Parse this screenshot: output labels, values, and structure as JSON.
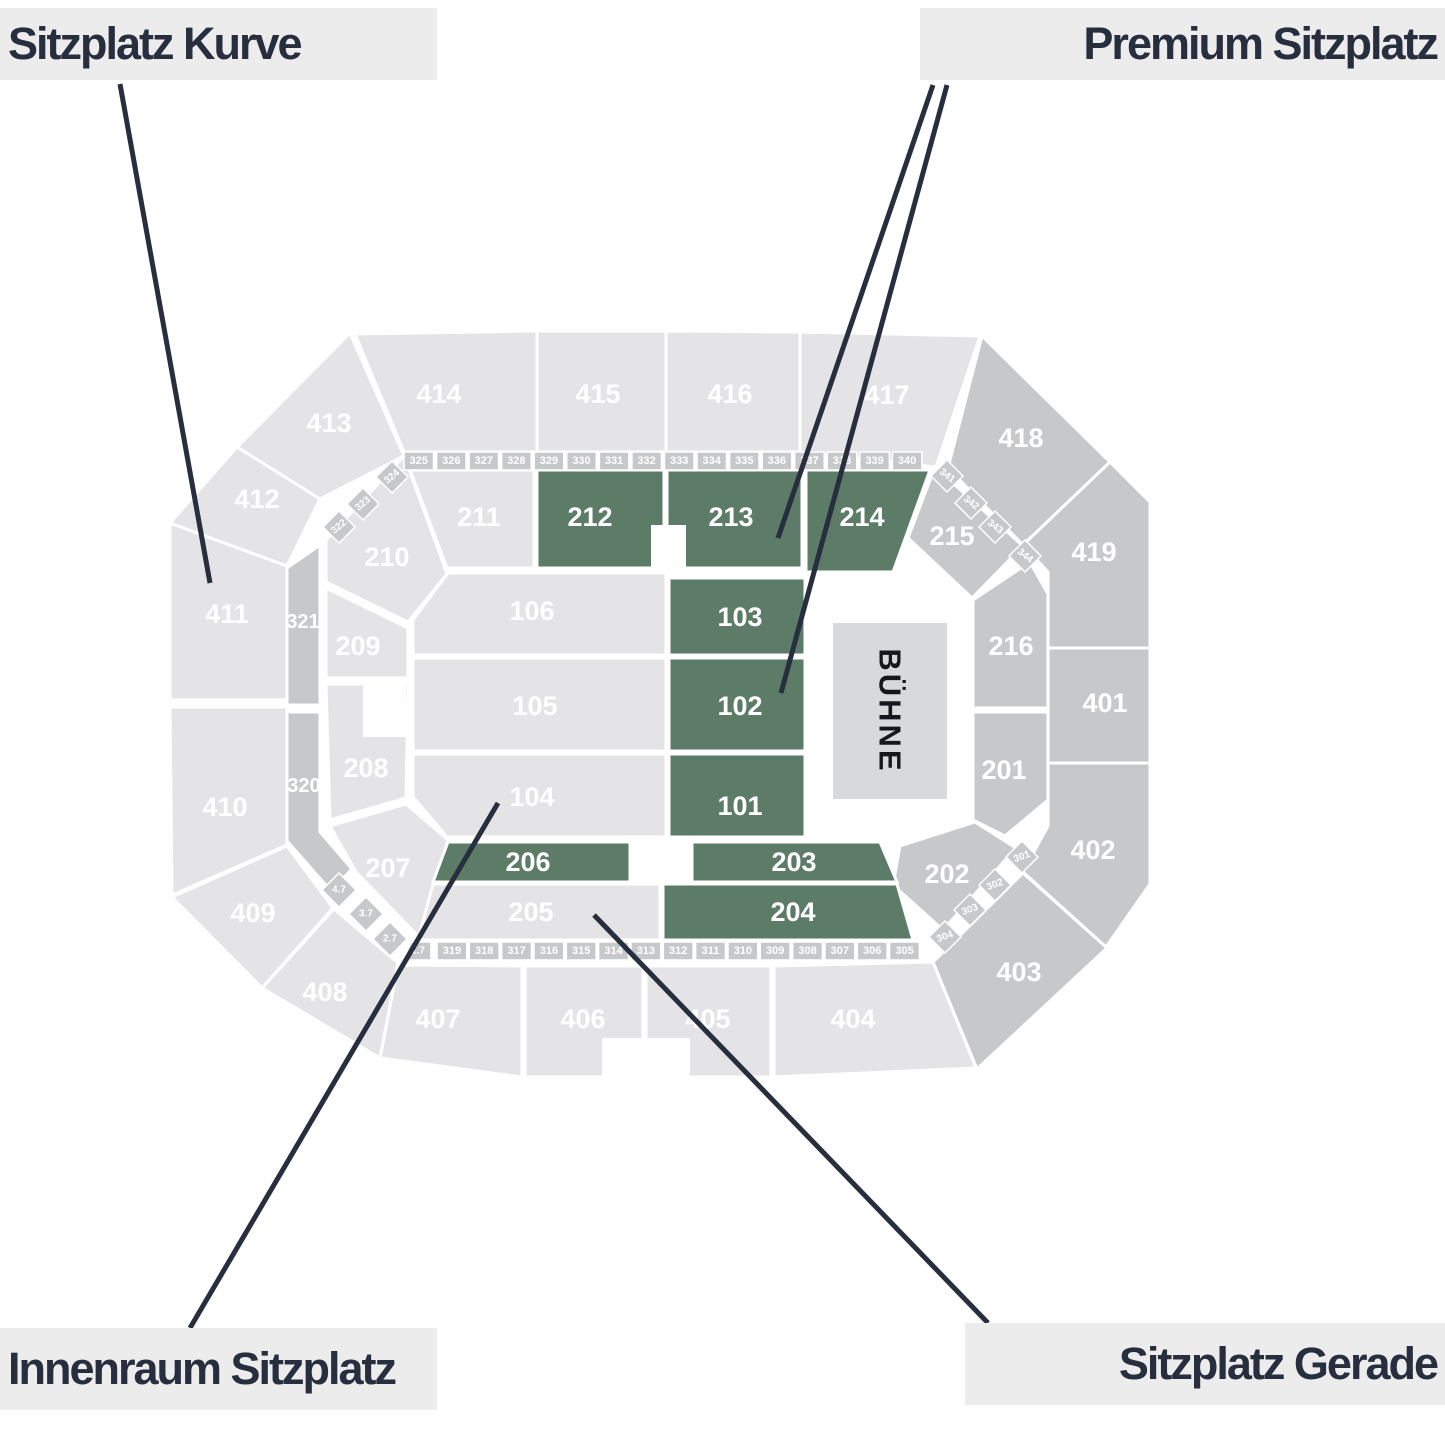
{
  "palette": {
    "light": "#e4e4e6",
    "mid": "#c7c8ca",
    "green": "#5d7c68",
    "stage_bg": "#d8d9db",
    "label_bg": "#ececec",
    "ink": "#272e3e",
    "section_text": "#ffffff",
    "stage_text": "#15171c"
  },
  "legend": {
    "top_left": "Sitzplatz Kurve",
    "top_right": "Premium Sitzplatz",
    "bottom_left": "Innenraum Sitzplatz",
    "bottom_right": "Sitzplatz Gerade"
  },
  "stage": {
    "label": "BÜHNE"
  },
  "sections": [
    {
      "id": "413",
      "label": "413",
      "role": "light"
    },
    {
      "id": "414",
      "label": "414",
      "role": "light"
    },
    {
      "id": "415",
      "label": "415",
      "role": "light"
    },
    {
      "id": "416",
      "label": "416",
      "role": "light"
    },
    {
      "id": "417",
      "label": "417",
      "role": "light"
    },
    {
      "id": "418",
      "label": "418",
      "role": "mid"
    },
    {
      "id": "419",
      "label": "419",
      "role": "mid"
    },
    {
      "id": "401",
      "label": "401",
      "role": "mid"
    },
    {
      "id": "402",
      "label": "402",
      "role": "mid"
    },
    {
      "id": "403",
      "label": "403",
      "role": "mid"
    },
    {
      "id": "404",
      "label": "404",
      "role": "light"
    },
    {
      "id": "405",
      "label": "405",
      "role": "light"
    },
    {
      "id": "406",
      "label": "406",
      "role": "light"
    },
    {
      "id": "407",
      "label": "407",
      "role": "light"
    },
    {
      "id": "408",
      "label": "408",
      "role": "light"
    },
    {
      "id": "409",
      "label": "409",
      "role": "light"
    },
    {
      "id": "410",
      "label": "410",
      "role": "light"
    },
    {
      "id": "411",
      "label": "411",
      "role": "light"
    },
    {
      "id": "412",
      "label": "412",
      "role": "light"
    },
    {
      "id": "210",
      "label": "210",
      "role": "light"
    },
    {
      "id": "211",
      "label": "211",
      "role": "light"
    },
    {
      "id": "212",
      "label": "212",
      "role": "green"
    },
    {
      "id": "213",
      "label": "213",
      "role": "green"
    },
    {
      "id": "214",
      "label": "214",
      "role": "green"
    },
    {
      "id": "215",
      "label": "215",
      "role": "mid"
    },
    {
      "id": "216",
      "label": "216",
      "role": "mid"
    },
    {
      "id": "201",
      "label": "201",
      "role": "mid"
    },
    {
      "id": "202",
      "label": "202",
      "role": "mid"
    },
    {
      "id": "209",
      "label": "209",
      "role": "light"
    },
    {
      "id": "208",
      "label": "208",
      "role": "light"
    },
    {
      "id": "207",
      "label": "207",
      "role": "light"
    },
    {
      "id": "321",
      "label": "321",
      "role": "mid"
    },
    {
      "id": "320",
      "label": "320",
      "role": "mid"
    },
    {
      "id": "106",
      "label": "106",
      "role": "light"
    },
    {
      "id": "105",
      "label": "105",
      "role": "light"
    },
    {
      "id": "104",
      "label": "104",
      "role": "light"
    },
    {
      "id": "103",
      "label": "103",
      "role": "green"
    },
    {
      "id": "102",
      "label": "102",
      "role": "green"
    },
    {
      "id": "101",
      "label": "101",
      "role": "green"
    },
    {
      "id": "206",
      "label": "206",
      "role": "green"
    },
    {
      "id": "205",
      "label": "205",
      "role": "light"
    },
    {
      "id": "203",
      "label": "203",
      "role": "green"
    },
    {
      "id": "204",
      "label": "204",
      "role": "green"
    },
    {
      "id": "322",
      "label": "322",
      "role": "mid"
    },
    {
      "id": "323",
      "label": "323",
      "role": "mid"
    },
    {
      "id": "324",
      "label": "324",
      "role": "mid"
    },
    {
      "id": "325",
      "label": "325",
      "role": "mid"
    },
    {
      "id": "326",
      "label": "326",
      "role": "mid"
    },
    {
      "id": "327",
      "label": "327",
      "role": "mid"
    },
    {
      "id": "328",
      "label": "328",
      "role": "mid"
    },
    {
      "id": "329",
      "label": "329",
      "role": "mid"
    },
    {
      "id": "330",
      "label": "330",
      "role": "mid"
    },
    {
      "id": "331",
      "label": "331",
      "role": "mid"
    },
    {
      "id": "332",
      "label": "332",
      "role": "mid"
    },
    {
      "id": "333",
      "label": "333",
      "role": "mid"
    },
    {
      "id": "334",
      "label": "334",
      "role": "mid"
    },
    {
      "id": "335",
      "label": "335",
      "role": "mid"
    },
    {
      "id": "336",
      "label": "336",
      "role": "mid"
    },
    {
      "id": "337",
      "label": "337",
      "role": "mid"
    },
    {
      "id": "338",
      "label": "338",
      "role": "mid"
    },
    {
      "id": "339",
      "label": "339",
      "role": "mid"
    },
    {
      "id": "340",
      "label": "340",
      "role": "mid"
    },
    {
      "id": "341",
      "label": "341",
      "role": "mid"
    },
    {
      "id": "342",
      "label": "342",
      "role": "mid"
    },
    {
      "id": "343",
      "label": "343",
      "role": "mid"
    },
    {
      "id": "344",
      "label": "344",
      "role": "mid"
    },
    {
      "id": "301",
      "label": "301",
      "role": "mid"
    },
    {
      "id": "302",
      "label": "302",
      "role": "mid"
    },
    {
      "id": "303",
      "label": "303",
      "role": "mid"
    },
    {
      "id": "304",
      "label": "304",
      "role": "mid"
    },
    {
      "id": "305",
      "label": "305",
      "role": "mid"
    },
    {
      "id": "306",
      "label": "306",
      "role": "mid"
    },
    {
      "id": "307",
      "label": "307",
      "role": "mid"
    },
    {
      "id": "308",
      "label": "308",
      "role": "mid"
    },
    {
      "id": "309",
      "label": "309",
      "role": "mid"
    },
    {
      "id": "310",
      "label": "310",
      "role": "mid"
    },
    {
      "id": "311",
      "label": "311",
      "role": "mid"
    },
    {
      "id": "312",
      "label": "312",
      "role": "mid"
    },
    {
      "id": "313",
      "label": "313",
      "role": "mid"
    },
    {
      "id": "314",
      "label": "314",
      "role": "mid"
    },
    {
      "id": "315",
      "label": "315",
      "role": "mid"
    },
    {
      "id": "316",
      "label": "316",
      "role": "mid"
    },
    {
      "id": "317",
      "label": "317",
      "role": "mid"
    },
    {
      "id": "318",
      "label": "318",
      "role": "mid"
    },
    {
      "id": "319",
      "label": "319",
      "role": "mid"
    },
    {
      "id": "1.7",
      "label": "1.7",
      "role": "mid"
    },
    {
      "id": "2.7",
      "label": "2.7",
      "role": "mid"
    },
    {
      "id": "3.7",
      "label": "3.7",
      "role": "mid"
    },
    {
      "id": "4.7",
      "label": "4.7",
      "role": "mid"
    }
  ]
}
